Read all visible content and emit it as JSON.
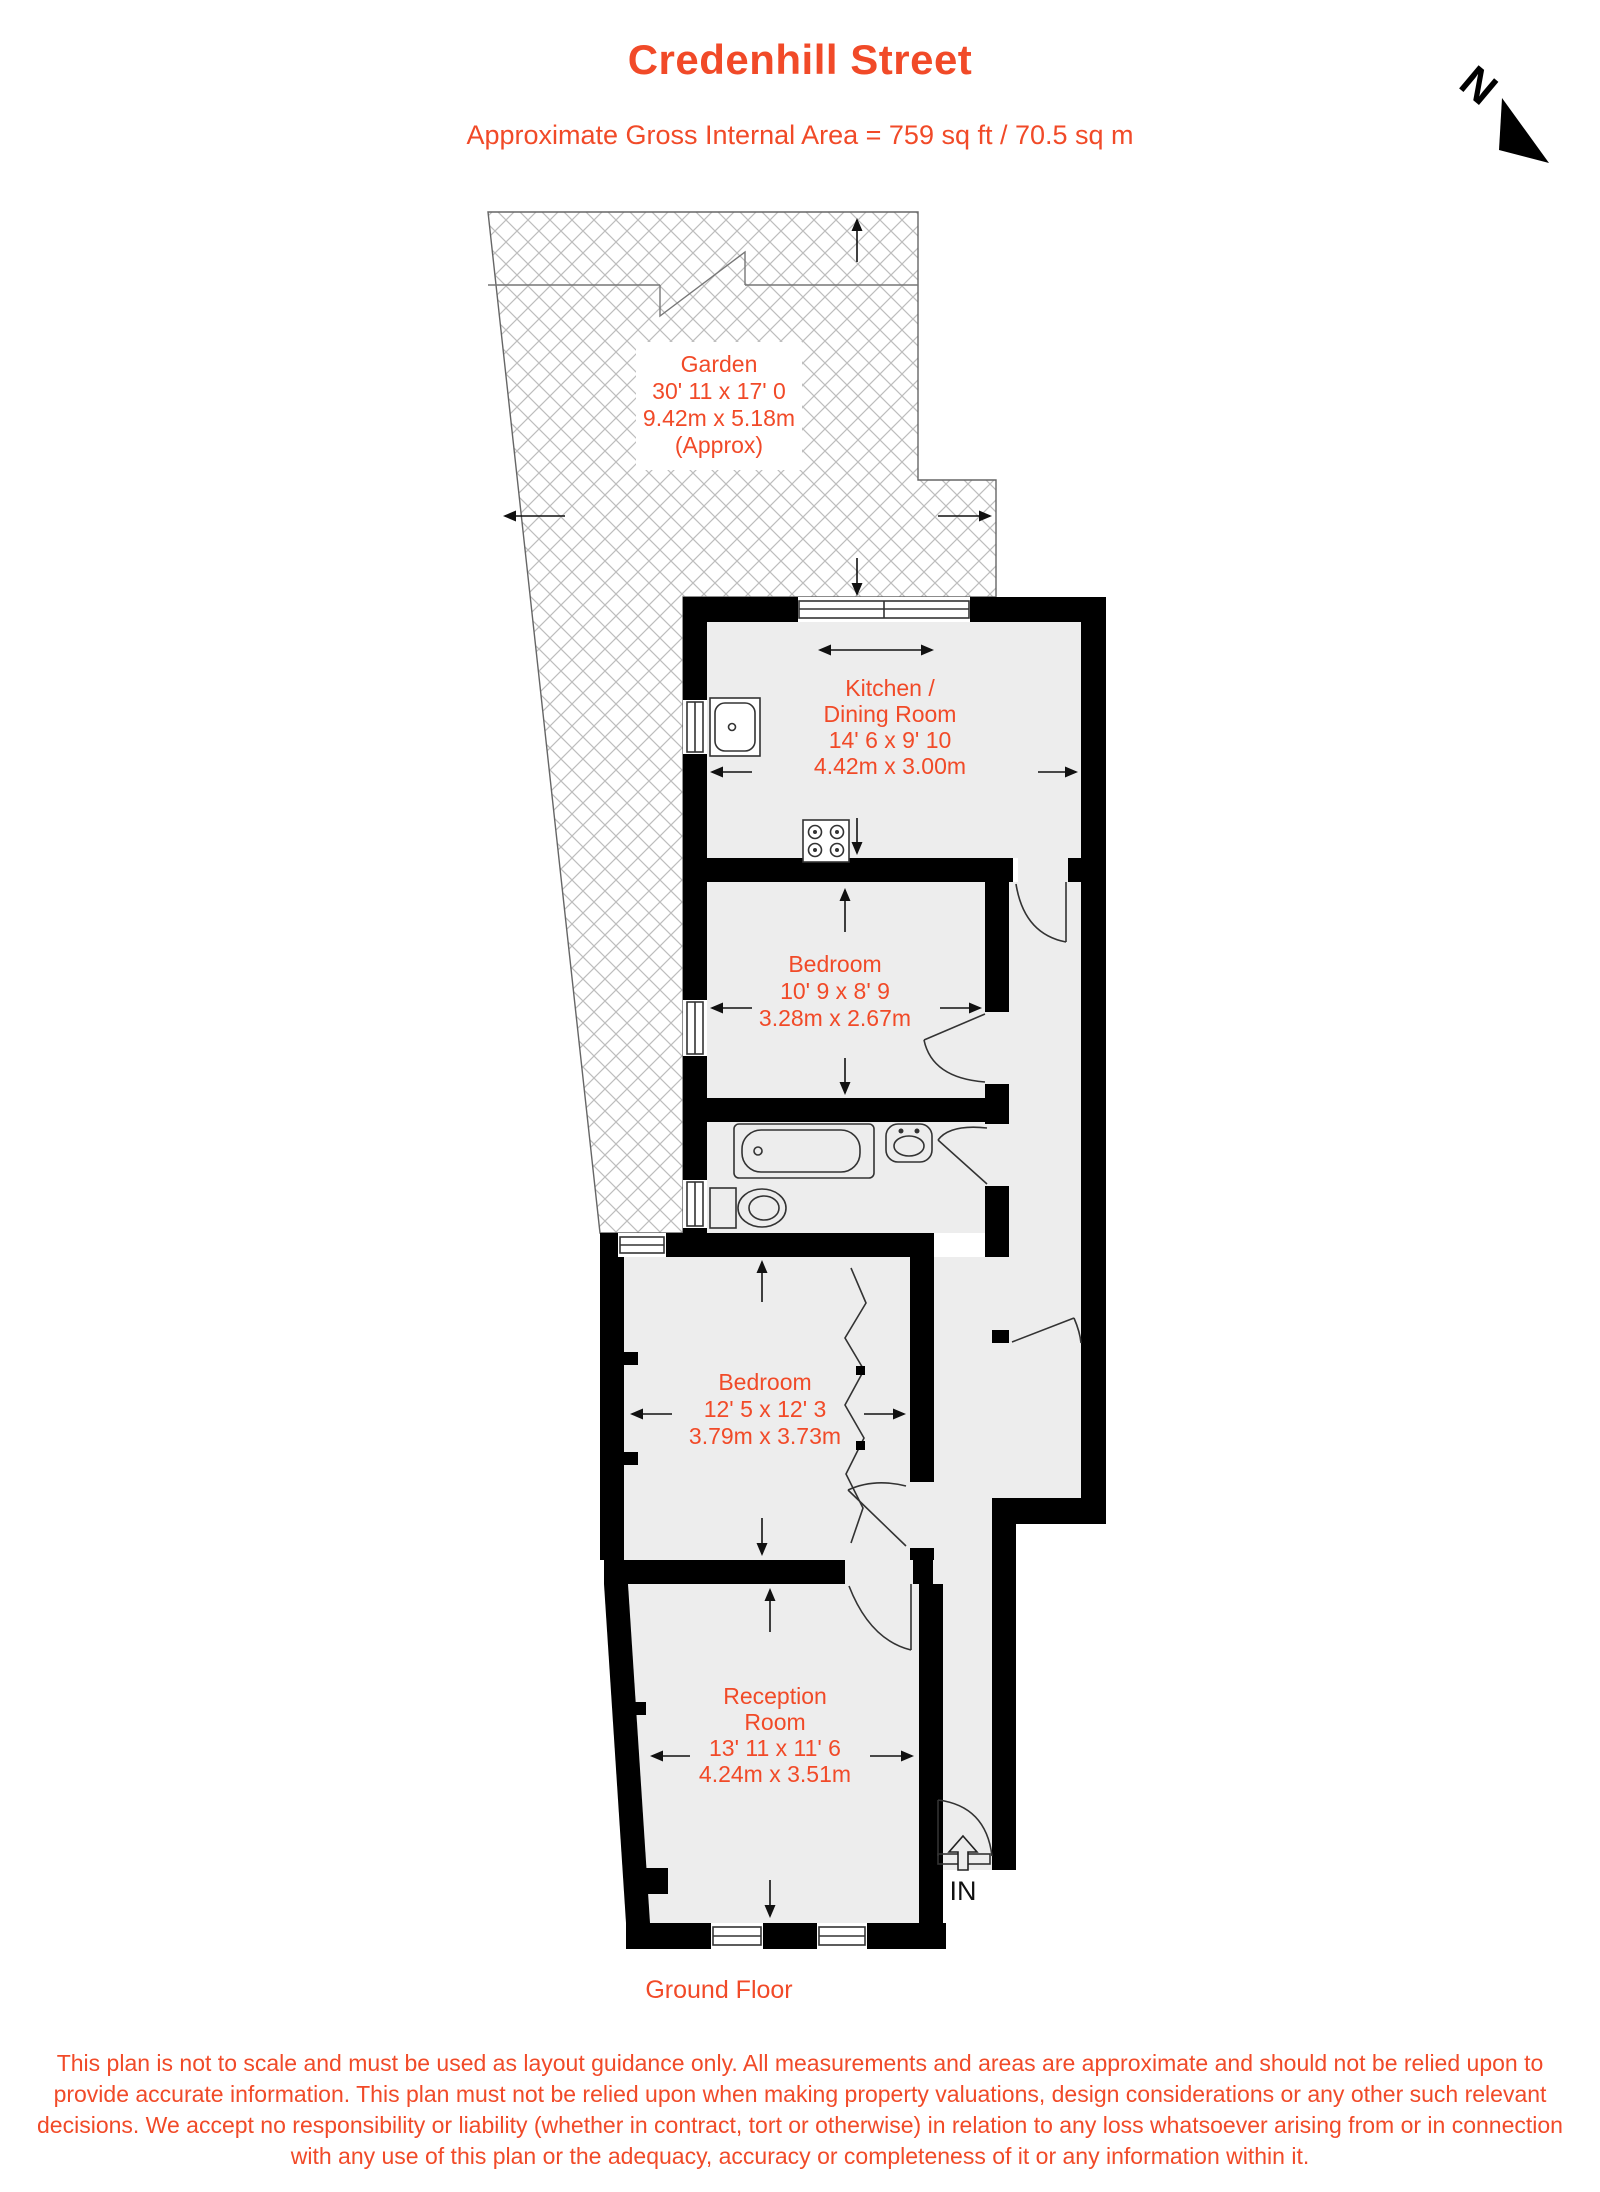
{
  "header": {
    "title": "Credenhill Street",
    "subtitle": "Approximate Gross Internal Area = 759 sq ft / 70.5 sq m"
  },
  "compass": {
    "label": "N"
  },
  "entrance": {
    "label": "IN"
  },
  "floor_label": "Ground Floor",
  "rooms": [
    {
      "id": "garden",
      "name": "Garden",
      "dims_imperial": "30' 11 x 17' 0",
      "dims_metric": "9.42m x 5.18m",
      "note": "(Approx)"
    },
    {
      "id": "kitchen-dining",
      "name_line1": "Kitchen /",
      "name_line2": "Dining Room",
      "dims_imperial": "14' 6 x 9' 10",
      "dims_metric": "4.42m x 3.00m"
    },
    {
      "id": "bedroom-1",
      "name": "Bedroom",
      "dims_imperial": "10' 9 x 8' 9",
      "dims_metric": "3.28m x 2.67m"
    },
    {
      "id": "bedroom-2",
      "name": "Bedroom",
      "dims_imperial": "12' 5 x 12' 3",
      "dims_metric": "3.79m x 3.73m"
    },
    {
      "id": "reception",
      "name_line1": "Reception",
      "name_line2": "Room",
      "dims_imperial": "13' 11 x 11' 6",
      "dims_metric": "4.24m x 3.51m"
    }
  ],
  "disclaimer": "This plan is not to scale and must be used as layout guidance only. All measurements and areas are approximate and should not be relied upon to provide accurate information. This plan must not be relied upon when making property valuations, design considerations or any other such relevant decisions. We accept no responsibility or liability (whether in contract, tort or otherwise) in relation to any loss whatsoever arising from or in connection with any use of this plan or the adequacy, accuracy or completeness of it or any information within it.",
  "colors": {
    "accent": "#f14a28",
    "room_fill": "#ededed",
    "wall": "#000000",
    "hatch": "#bdbdbd"
  }
}
